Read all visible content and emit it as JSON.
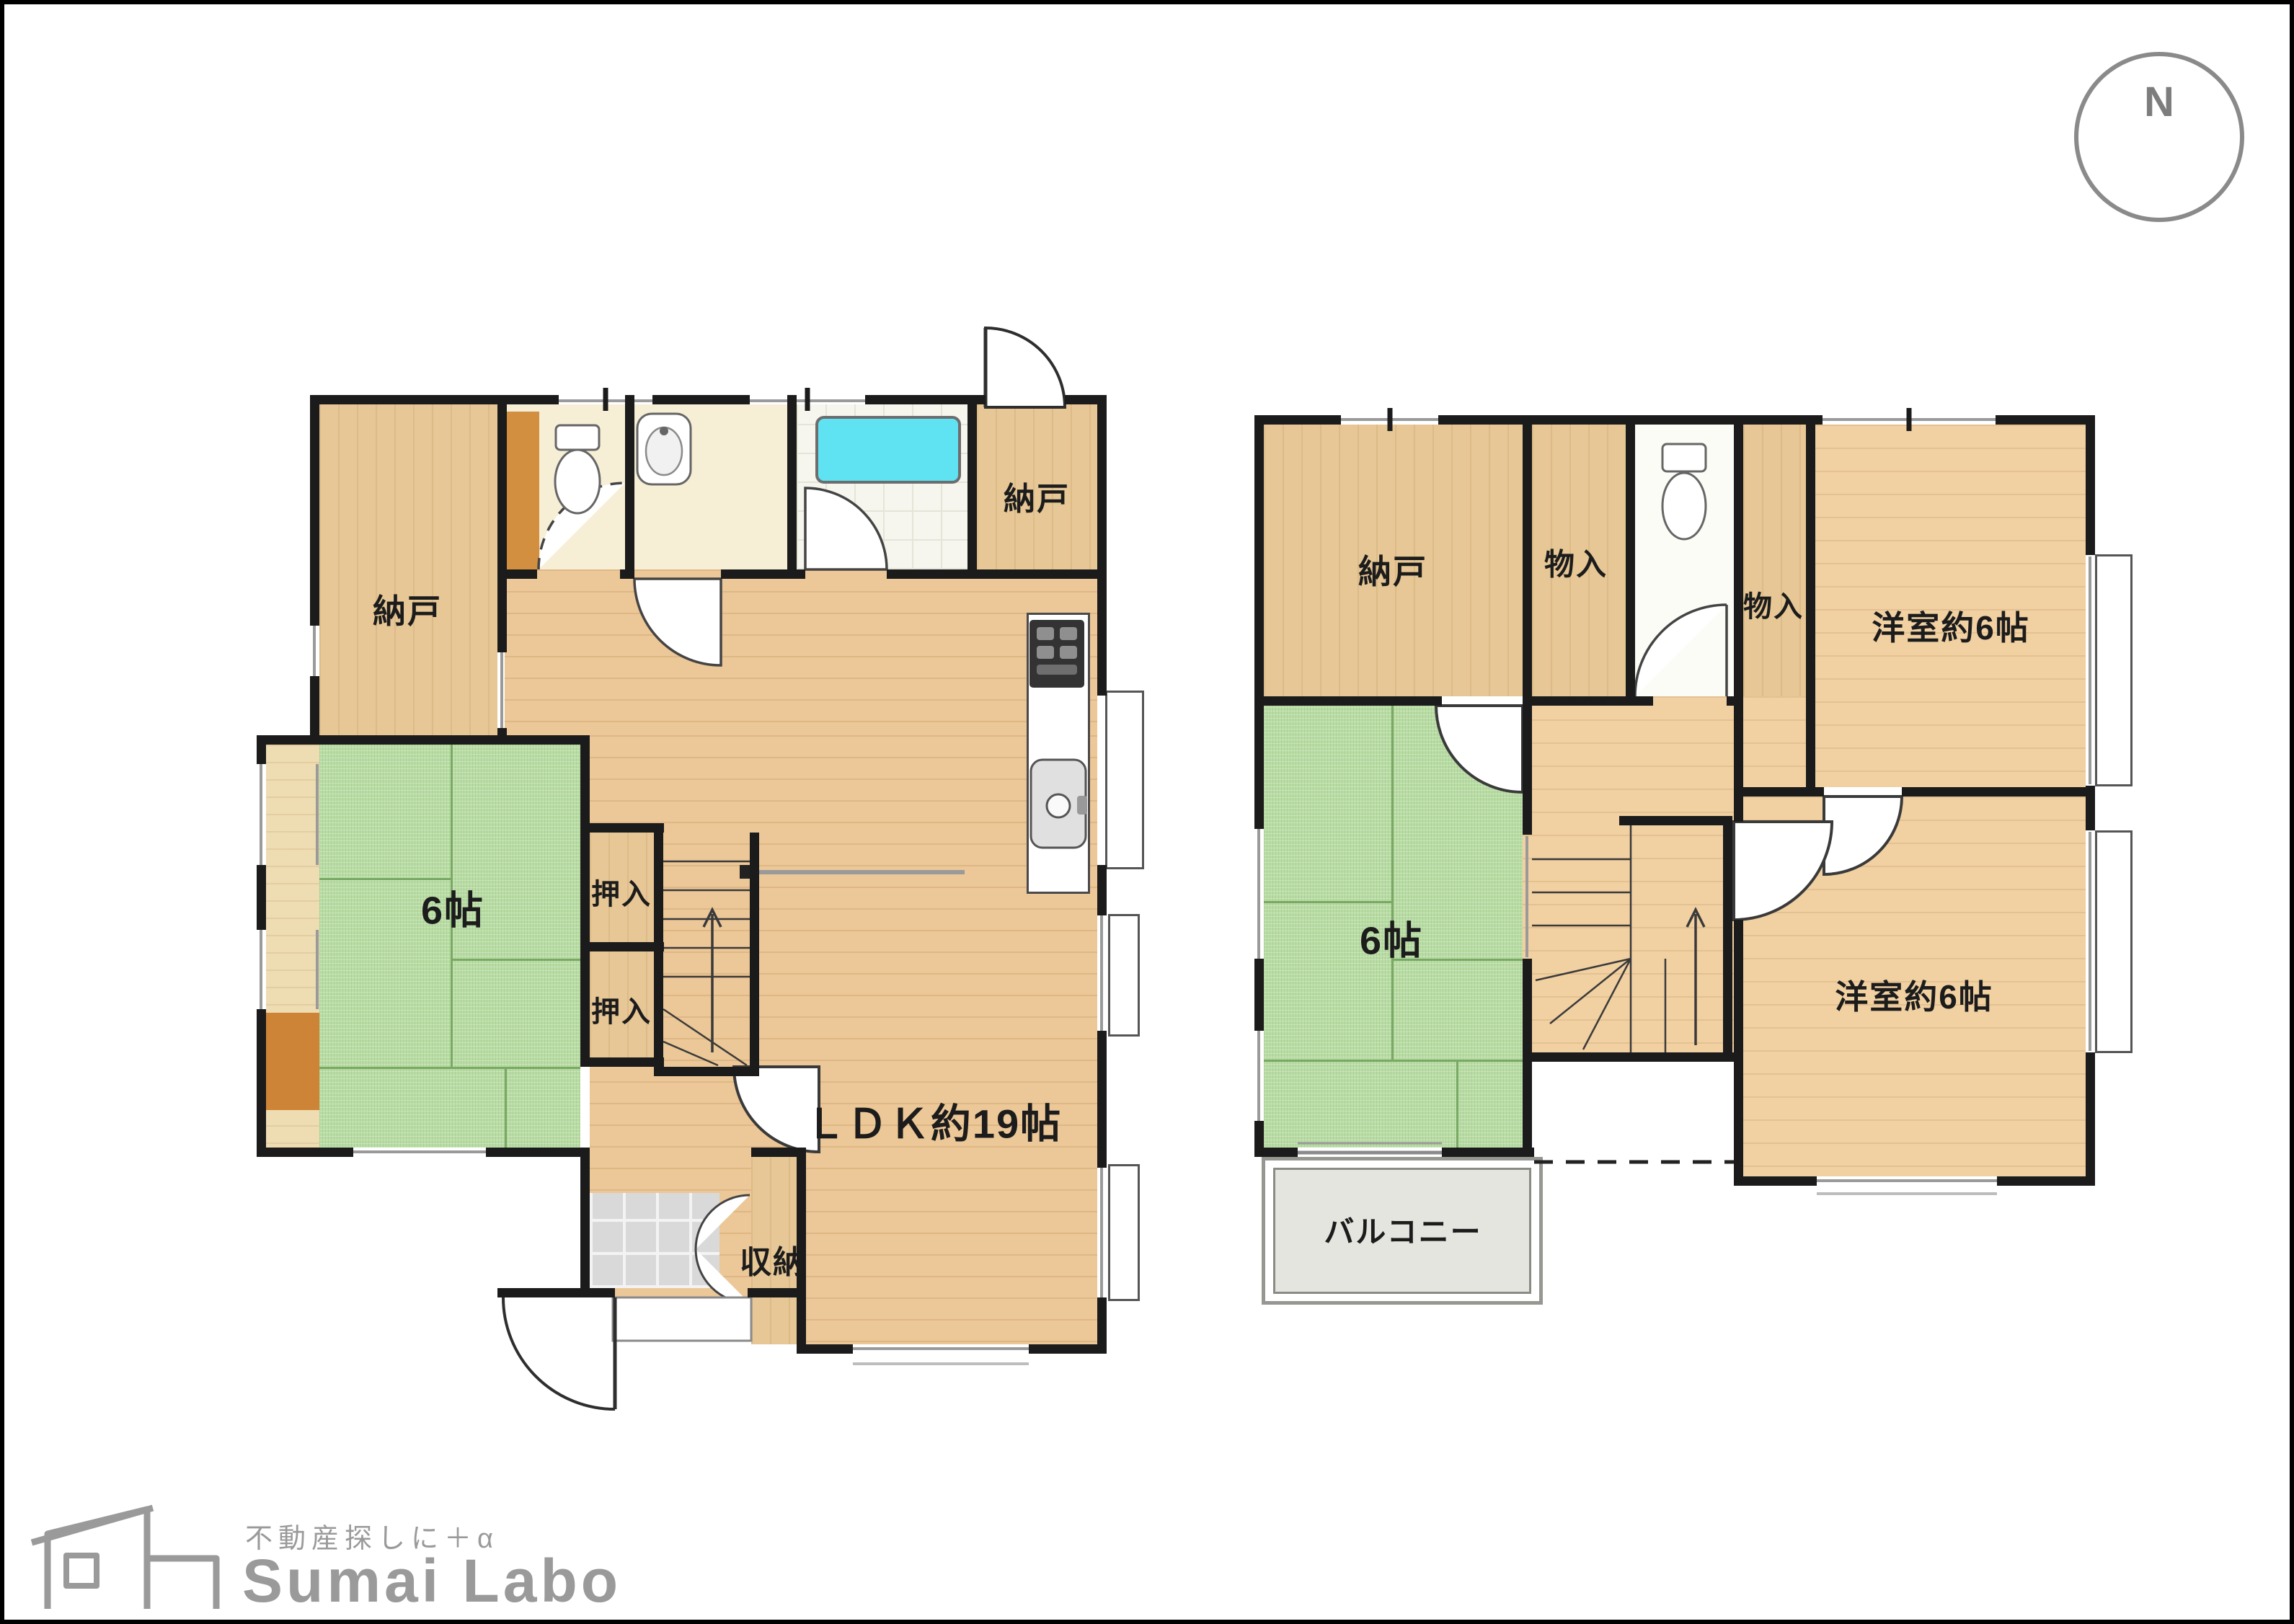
{
  "compass": {
    "north_label": "N"
  },
  "floor1": {
    "labels": {
      "nando_left": "納戸",
      "nando_top": "納戸",
      "oshiire_top": "押入",
      "oshiire_bottom": "押入",
      "tatami": "6帖",
      "ldk": "ＬＤＫ約19帖",
      "shuno": "収納"
    }
  },
  "floor2": {
    "labels": {
      "nando": "納戸",
      "monoire_top": "物入",
      "monoire_right": "物入",
      "yoshitsu_top": "洋室約6帖",
      "tatami": "6帖",
      "yoshitsu_bottom": "洋室約6帖",
      "balcony": "バルコニー"
    }
  },
  "logo": {
    "tagline": "不動産探しに＋α",
    "name": "Sumai Labo"
  },
  "icons": {
    "compass_arrow": "north-arrow-icon",
    "toilet": "toilet-icon",
    "washbasin": "washbasin-icon",
    "bathtub": "bathtub-icon",
    "stove": "stove-icon",
    "kitchen_sink": "kitchen-sink-icon",
    "stairs": "stairs-icon",
    "logo_house": "house-icon"
  },
  "colors": {
    "wall": "#1b1b1b",
    "wood_floor_1f": "#ecc797",
    "wood_floor_2f": "#f1d0a2",
    "closet_wood": "#e6c795",
    "tatami_green": "#b9dca4",
    "cream": "#f6efd6",
    "tub_cyan": "#5fe2f2",
    "cabinet_orange": "#d28f40",
    "entry_tile": "#d9d9d9",
    "balcony_gray": "#e5e5df",
    "line_gray": "#8a8a8a"
  }
}
